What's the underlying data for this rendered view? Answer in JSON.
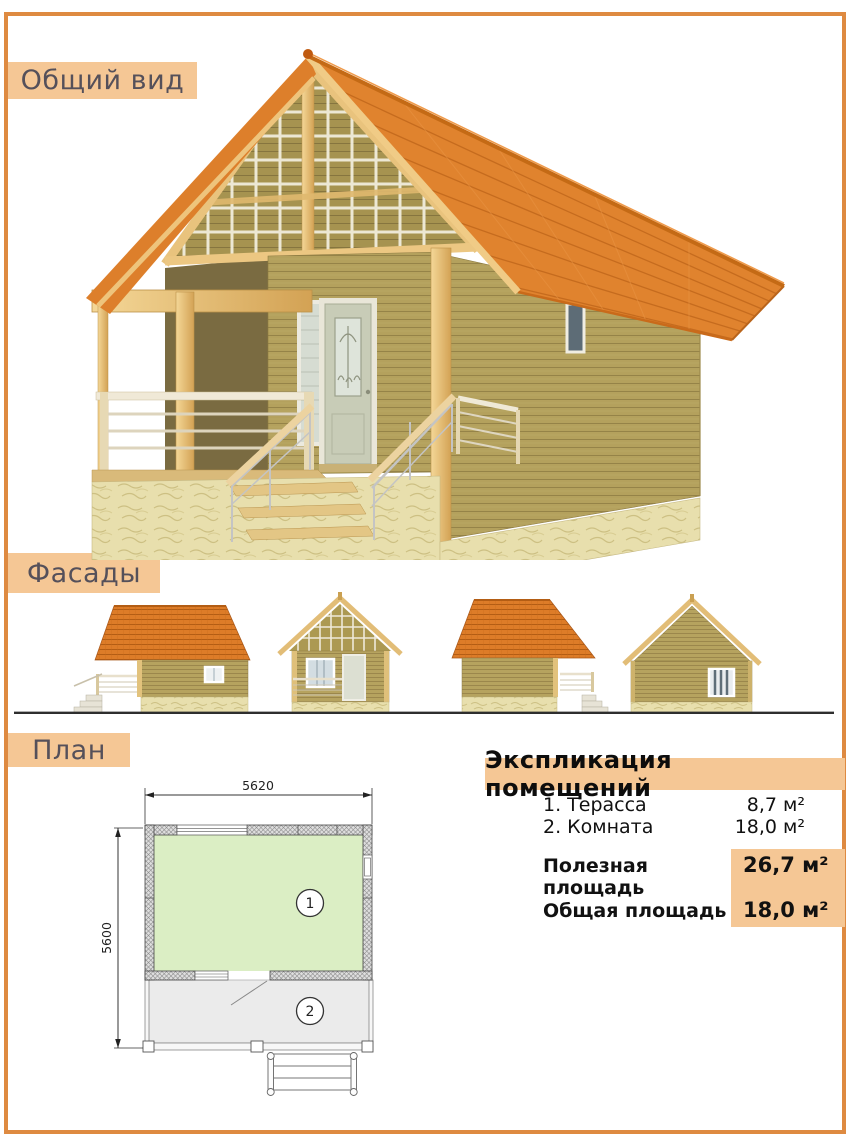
{
  "sections": [
    {
      "id": "general-view",
      "label": "Общий вид"
    },
    {
      "id": "facades",
      "label": "Фасады"
    },
    {
      "id": "plan",
      "label": "План"
    }
  ],
  "plan": {
    "width_mm": "5620",
    "height_mm": "5600",
    "room_numbers": [
      "1",
      "2"
    ]
  },
  "explication": {
    "title": "Экспликация помещений",
    "rooms": [
      {
        "name": "1. Терасса",
        "area": "8,7 м²"
      },
      {
        "name": "2. Комната",
        "area": "18,0 м²"
      }
    ],
    "totals": [
      {
        "name": "Полезная площадь",
        "area": "26,7 м²"
      },
      {
        "name": "Общая площадь",
        "area": "18,0 м²"
      }
    ]
  },
  "colors": {
    "frame": "#de8a41",
    "banner_bg": "#f5c795",
    "banner_text": "#55505a",
    "highlight_bg": "#f5c795",
    "roof_orange": "#e0832e",
    "wood": "#b4a15d",
    "beam": "#ecc782",
    "stone": "#e8dfad",
    "plan_room_fill": "#dbeec4",
    "plan_terrace_fill": "#ebebeb"
  }
}
